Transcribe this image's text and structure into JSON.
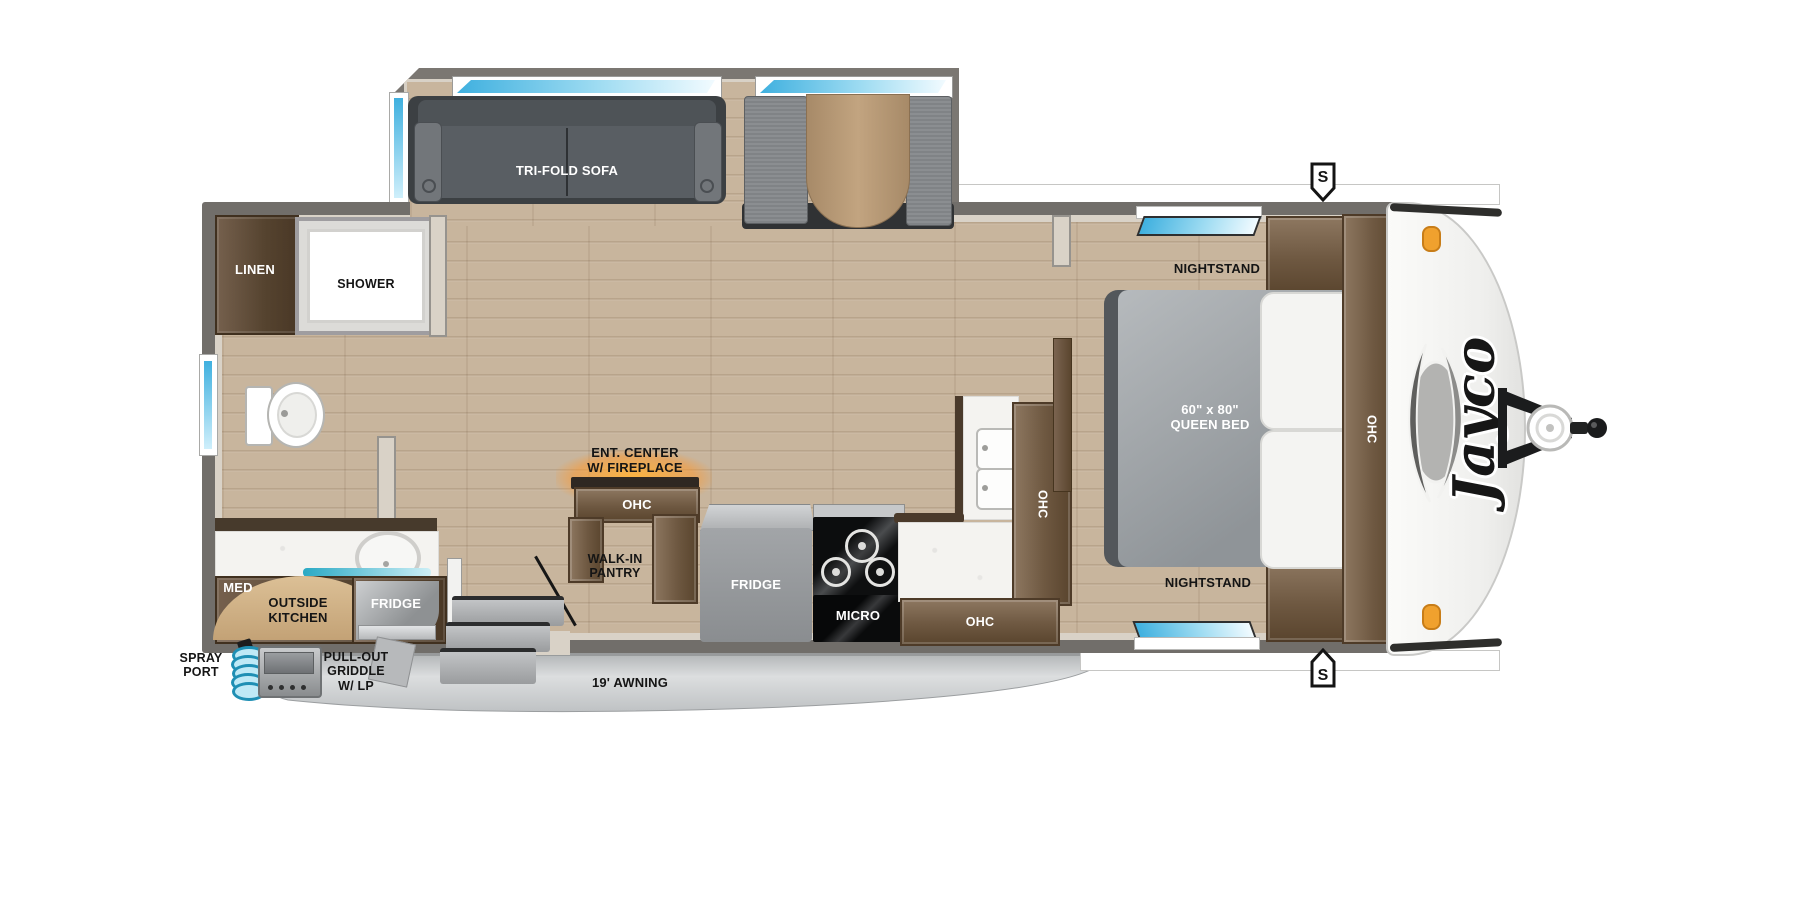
{
  "brand_logo": "Jayco",
  "side_markers": {
    "top": "S",
    "bottom": "S"
  },
  "slideout": {
    "sofa": "TRI-FOLD SOFA"
  },
  "bathroom": {
    "linen": "LINEN",
    "shower": "SHOWER"
  },
  "living": {
    "ent_center": [
      "ENT. CENTER",
      "W/ FIREPLACE"
    ],
    "ent_center_ohc": "OHC",
    "walk_in_pantry": [
      "WALK-IN",
      "PANTRY"
    ]
  },
  "kitchen": {
    "fridge": "FRIDGE",
    "micro": "MICRO",
    "ohc_tall": "OHC",
    "ohc_lower": "OHC"
  },
  "bedroom": {
    "nightstand_top": "NIGHTSTAND",
    "nightstand_bottom": "NIGHTSTAND",
    "bed": [
      "60\" x 80\"",
      "QUEEN BED"
    ],
    "ohc": "OHC"
  },
  "outside": {
    "med": "MED",
    "kitchen": [
      "OUTSIDE",
      "KITCHEN"
    ],
    "fridge": "FRIDGE",
    "spray_port": [
      "SPRAY",
      "PORT"
    ],
    "griddle": [
      "PULL-OUT",
      "GRIDDLE",
      "W/ LP"
    ],
    "awning": "19' AWNING"
  },
  "colors": {
    "wall": "#716e6a",
    "wall_lining": "#d9d2c7",
    "floor_wood": "#c8b59d",
    "cabinet_wood": "#7b6450",
    "window_blue": "#49b7e4",
    "outside_kitchen_tan": "#cfae87",
    "awning_gray": "#c3c6c8",
    "fireplace_glow": "#ffa733",
    "marker_light_orange": "#f0a12e"
  }
}
